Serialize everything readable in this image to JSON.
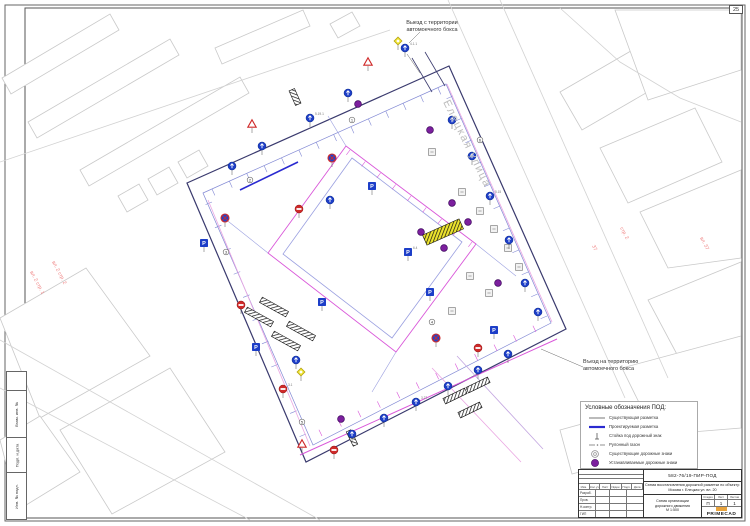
{
  "sheet": {
    "format_label": "25"
  },
  "stamps_left": [
    "Взам. инв. №",
    "Подп. и дата",
    "Инв. № подл."
  ],
  "annotations": {
    "exit_top": {
      "line1": "Выезд с территории",
      "line2": "автомоечного бокса"
    },
    "entry_right": {
      "line1": "Въезд на территорию",
      "line2": "автомоечного бокса"
    }
  },
  "legend": {
    "title": "Условные обозначения ПОД:",
    "items": [
      {
        "sym": "line-thin",
        "label": "Существующая разметка"
      },
      {
        "sym": "line-thick",
        "label": "Проектируемая разметка"
      },
      {
        "sym": "post",
        "label": "Стойка под дорожный знак"
      },
      {
        "sym": "dashdot",
        "label": "Рулонный газон"
      },
      {
        "sym": "circle-gray",
        "label": "Существующие дорожные знаки"
      },
      {
        "sym": "circle-purple",
        "label": "Устанавливаемые дорожные знаки"
      }
    ]
  },
  "title_block": {
    "code": "582-76/19-ПИР-ПОД",
    "object_lines": [
      "Схема восстановления дорожной разметки по объекту:",
      "Москва г. Елецкая ул. вл. 20"
    ],
    "columns": [
      "Изм.",
      "Кол.уч",
      "Лист",
      "№док.",
      "Подп.",
      "Дата"
    ],
    "roles": [
      "Разраб.",
      "Пров.",
      "Н.контр.",
      "ГИП"
    ],
    "stage_label": "Стадия",
    "sheet_label": "Лист",
    "sheets_label": "Листов",
    "stage": "П",
    "sheet": "1",
    "sheets": "1",
    "drawing_name_lines": [
      "Схема организации",
      "дорожного движения",
      "М 1:500"
    ],
    "logo": "PRIMECAD"
  },
  "map": {
    "colors": {
      "building": "#c9c9c9",
      "road": "#d2d2d2",
      "boundary": "#3a3a6e",
      "inner": "#8289d4",
      "courtyard": "#9ba0e0",
      "magenta": "#d957d9",
      "pink": "#eaa6e2",
      "lavender": "#c3a6e0",
      "blue": "#2a2ad0",
      "sign_blue": "#1d3ec8",
      "sign_red": "#cf2a2a",
      "purple": "#7c1f9e",
      "gray": "#8f8f8f",
      "yellow": "#ece32e",
      "leader": "#666666",
      "street_text": "#bdbdbd",
      "red_text": "#ef8080",
      "bar": "#1a1a1a"
    },
    "street_label": {
      "text": "Елецкая улица",
      "x": 443,
      "y": 102,
      "rot": 64,
      "size": 11
    },
    "red_labels": [
      {
        "text": "вл. 2 стр. 1",
        "x": 30,
        "y": 272,
        "rot": 62
      },
      {
        "text": "вл. 2 стр. 2",
        "x": 52,
        "y": 262,
        "rot": 62
      },
      {
        "text": "37",
        "x": 592,
        "y": 246,
        "rot": 62
      },
      {
        "text": "стр. 2",
        "x": 620,
        "y": 228,
        "rot": 62
      },
      {
        "text": "вл. 37",
        "x": 700,
        "y": 238,
        "rot": 62
      }
    ],
    "buildings": [
      [
        [
          2,
          78
        ],
        [
          110,
          14
        ],
        [
          119,
          30
        ],
        [
          11,
          94
        ]
      ],
      [
        [
          28,
          122
        ],
        [
          170,
          39
        ],
        [
          179,
          55
        ],
        [
          37,
          138
        ]
      ],
      [
        [
          80,
          170
        ],
        [
          240,
          77
        ],
        [
          249,
          93
        ],
        [
          89,
          186
        ]
      ],
      [
        [
          118,
          196
        ],
        [
          139,
          184
        ],
        [
          148,
          200
        ],
        [
          127,
          212
        ]
      ],
      [
        [
          148,
          179
        ],
        [
          169,
          167
        ],
        [
          178,
          183
        ],
        [
          157,
          195
        ]
      ],
      [
        [
          178,
          162
        ],
        [
          199,
          150
        ],
        [
          208,
          166
        ],
        [
          187,
          178
        ]
      ],
      [
        [
          215,
          48
        ],
        [
          303,
          10
        ],
        [
          310,
          26
        ],
        [
          222,
          64
        ]
      ],
      [
        [
          330,
          24
        ],
        [
          352,
          12
        ],
        [
          360,
          26
        ],
        [
          338,
          38
        ]
      ],
      [
        [
          560,
          92
        ],
        [
          636,
          48
        ],
        [
          658,
          86
        ],
        [
          582,
          130
        ]
      ],
      [
        [
          615,
          10
        ],
        [
          741,
          10
        ],
        [
          741,
          70
        ],
        [
          648,
          100
        ]
      ],
      [
        [
          600,
          148
        ],
        [
          695,
          108
        ],
        [
          722,
          162
        ],
        [
          628,
          203
        ]
      ],
      [
        [
          640,
          212
        ],
        [
          741,
          170
        ],
        [
          741,
          258
        ],
        [
          668,
          268
        ]
      ],
      [
        [
          648,
          300
        ],
        [
          741,
          262
        ],
        [
          741,
          350
        ],
        [
          680,
          360
        ]
      ],
      [
        [
          622,
          368
        ],
        [
          741,
          336
        ],
        [
          741,
          428
        ],
        [
          655,
          435
        ]
      ],
      [
        [
          560,
          430
        ],
        [
          640,
          408
        ],
        [
          652,
          452
        ],
        [
          572,
          474
        ]
      ],
      [
        [
          0,
          318
        ],
        [
          86,
          268
        ],
        [
          150,
          356
        ],
        [
          40,
          418
        ]
      ],
      [
        [
          60,
          430
        ],
        [
          170,
          368
        ],
        [
          225,
          452
        ],
        [
          112,
          514
        ]
      ],
      [
        [
          0,
          440
        ],
        [
          40,
          416
        ],
        [
          80,
          472
        ],
        [
          18,
          510
        ]
      ]
    ],
    "roads": [
      [
        [
          448,
          0
        ],
        [
          625,
          398
        ]
      ],
      [
        [
          500,
          0
        ],
        [
          668,
          378
        ]
      ],
      [
        [
          560,
          8
        ],
        [
          620,
          62
        ],
        [
          680,
          98
        ],
        [
          741,
          122
        ]
      ],
      [
        [
          0,
          340
        ],
        [
          320,
          520
        ]
      ],
      [
        [
          0,
          388
        ],
        [
          250,
          520
        ]
      ],
      [
        [
          0,
          162
        ],
        [
          390,
          30
        ]
      ]
    ],
    "lot": {
      "outer": [
        [
          187,
          183
        ],
        [
          449,
          66
        ],
        [
          566,
          329
        ],
        [
          306,
          462
        ]
      ],
      "inner": [
        [
          203,
          193
        ],
        [
          446,
          84
        ],
        [
          551,
          323
        ],
        [
          313,
          445
        ]
      ],
      "courtyard": [
        [
          352,
          158
        ],
        [
          462,
          242
        ],
        [
          392,
          338
        ],
        [
          283,
          254
        ]
      ],
      "magenta_ring": [
        [
          346,
          146
        ],
        [
          476,
          244
        ],
        [
          396,
          352
        ],
        [
          268,
          253
        ]
      ]
    },
    "tick_rows": [
      {
        "from": [
          212,
          189
        ],
        "to": [
          438,
          88
        ],
        "n": 14,
        "len": 7,
        "color": "inner"
      },
      {
        "from": [
          453,
          96
        ],
        "to": [
          547,
          316
        ],
        "n": 11,
        "len": 7,
        "color": "inner"
      },
      {
        "from": [
          536,
          332
        ],
        "to": [
          322,
          436
        ],
        "n": 12,
        "len": 7,
        "color": "magenta"
      },
      {
        "from": [
          212,
          202
        ],
        "to": [
          306,
          434
        ],
        "n": 11,
        "len": 7,
        "color": "inner"
      },
      {
        "from": [
          350,
          150
        ],
        "to": [
          472,
          242
        ],
        "n": 9,
        "len": 6,
        "color": "magenta"
      }
    ],
    "markings": [
      {
        "pts": [
          [
            208,
            200
          ],
          [
            310,
            446
          ]
        ],
        "c": "pink",
        "w": 0.8
      },
      {
        "pts": [
          [
            447,
            84
          ],
          [
            552,
            322
          ]
        ],
        "c": "pink",
        "w": 0.8
      },
      {
        "pts": [
          [
            432,
            368
          ],
          [
            521,
            462
          ]
        ],
        "c": "pink",
        "w": 0.8
      },
      {
        "pts": [
          [
            457,
            356
          ],
          [
            543,
            449
          ]
        ],
        "c": "lavender",
        "w": 0.8
      },
      {
        "pts": [
          [
            300,
            455
          ],
          [
            557,
            339
          ]
        ],
        "c": "magenta",
        "w": 1
      },
      {
        "pts": [
          [
            240,
            190
          ],
          [
            298,
            162
          ]
        ],
        "c": "blue",
        "w": 1.6
      },
      {
        "pts": [
          [
            412,
            58
          ],
          [
            432,
            92
          ]
        ],
        "c": "boundary",
        "w": 0.8
      },
      {
        "pts": [
          [
            425,
            52
          ],
          [
            445,
            86
          ]
        ],
        "c": "boundary",
        "w": 0.8
      },
      {
        "pts": [
          [
            268,
            253
          ],
          [
            224,
            218
          ]
        ],
        "c": "courtyard",
        "w": 0.6
      },
      {
        "pts": [
          [
            476,
            244
          ],
          [
            516,
            276
          ]
        ],
        "c": "courtyard",
        "w": 0.6
      },
      {
        "pts": [
          [
            396,
            352
          ],
          [
            372,
            392
          ]
        ],
        "c": "courtyard",
        "w": 0.6
      },
      {
        "pts": [
          [
            346,
            146
          ],
          [
            328,
            116
          ]
        ],
        "c": "courtyard",
        "w": 0.6
      }
    ],
    "bars": [
      {
        "x": 295,
        "y": 97,
        "rot": 66,
        "w": 16,
        "h": 6,
        "style": "black"
      },
      {
        "x": 274,
        "y": 307,
        "rot": 29,
        "w": 30,
        "h": 6,
        "style": "black"
      },
      {
        "x": 259,
        "y": 317,
        "rot": 29,
        "w": 30,
        "h": 6,
        "style": "black"
      },
      {
        "x": 301,
        "y": 331,
        "rot": 29,
        "w": 30,
        "h": 6,
        "style": "black"
      },
      {
        "x": 286,
        "y": 341,
        "rot": 29,
        "w": 30,
        "h": 6,
        "style": "black"
      },
      {
        "x": 443,
        "y": 232,
        "rot": -24,
        "w": 40,
        "h": 11,
        "style": "yellow"
      },
      {
        "x": 455,
        "y": 396,
        "rot": -26,
        "w": 24,
        "h": 6,
        "style": "black"
      },
      {
        "x": 478,
        "y": 385,
        "rot": -26,
        "w": 24,
        "h": 6,
        "style": "black"
      },
      {
        "x": 470,
        "y": 410,
        "rot": -26,
        "w": 24,
        "h": 6,
        "style": "black"
      },
      {
        "x": 352,
        "y": 438,
        "rot": 64,
        "w": 16,
        "h": 5,
        "style": "black"
      }
    ],
    "signs": [
      {
        "t": "yd",
        "x": 398,
        "y": 41
      },
      {
        "t": "bc",
        "x": 405,
        "y": 48,
        "lbl": "4.1.1"
      },
      {
        "t": "wt",
        "x": 368,
        "y": 62
      },
      {
        "t": "bc",
        "x": 348,
        "y": 93
      },
      {
        "t": "pd",
        "x": 358,
        "y": 104
      },
      {
        "t": "bc",
        "x": 310,
        "y": 118,
        "lbl": "5.19.1"
      },
      {
        "t": "wt",
        "x": 252,
        "y": 124
      },
      {
        "t": "bc",
        "x": 262,
        "y": 146
      },
      {
        "t": "nx",
        "x": 332,
        "y": 158
      },
      {
        "t": "bc",
        "x": 232,
        "y": 166
      },
      {
        "t": "cn",
        "x": 250,
        "y": 180,
        "n": "2"
      },
      {
        "t": "bp",
        "x": 372,
        "y": 186
      },
      {
        "t": "cn",
        "x": 352,
        "y": 120,
        "n": "1"
      },
      {
        "t": "gb",
        "x": 432,
        "y": 152
      },
      {
        "t": "pd",
        "x": 430,
        "y": 130
      },
      {
        "t": "cn",
        "x": 480,
        "y": 140,
        "n": "6"
      },
      {
        "t": "bc",
        "x": 452,
        "y": 120
      },
      {
        "t": "bc",
        "x": 472,
        "y": 156
      },
      {
        "t": "gb",
        "x": 462,
        "y": 192
      },
      {
        "t": "pd",
        "x": 452,
        "y": 203
      },
      {
        "t": "bc",
        "x": 490,
        "y": 196,
        "lbl": "5.15"
      },
      {
        "t": "gb",
        "x": 480,
        "y": 211
      },
      {
        "t": "pd",
        "x": 468,
        "y": 222
      },
      {
        "t": "gb",
        "x": 494,
        "y": 229
      },
      {
        "t": "pd",
        "x": 421,
        "y": 232
      },
      {
        "t": "bp",
        "x": 408,
        "y": 252,
        "lbl": "6.4"
      },
      {
        "t": "gb",
        "x": 508,
        "y": 248
      },
      {
        "t": "pd",
        "x": 444,
        "y": 248
      },
      {
        "t": "gb",
        "x": 519,
        "y": 267
      },
      {
        "t": "bc",
        "x": 509,
        "y": 240
      },
      {
        "t": "bc",
        "x": 525,
        "y": 283
      },
      {
        "t": "pd",
        "x": 498,
        "y": 283
      },
      {
        "t": "gb",
        "x": 489,
        "y": 293
      },
      {
        "t": "gb",
        "x": 470,
        "y": 276
      },
      {
        "t": "bp",
        "x": 430,
        "y": 292
      },
      {
        "t": "gb",
        "x": 452,
        "y": 311
      },
      {
        "t": "bc",
        "x": 538,
        "y": 312
      },
      {
        "t": "bp",
        "x": 494,
        "y": 330
      },
      {
        "t": "cn",
        "x": 432,
        "y": 322,
        "n": "4"
      },
      {
        "t": "nx",
        "x": 436,
        "y": 338
      },
      {
        "t": "ne",
        "x": 478,
        "y": 348
      },
      {
        "t": "bc",
        "x": 508,
        "y": 354
      },
      {
        "t": "bc",
        "x": 478,
        "y": 370
      },
      {
        "t": "bc",
        "x": 448,
        "y": 386
      },
      {
        "t": "bc",
        "x": 416,
        "y": 402,
        "lbl": "3.27"
      },
      {
        "t": "bc",
        "x": 384,
        "y": 418
      },
      {
        "t": "pd",
        "x": 341,
        "y": 419
      },
      {
        "t": "bc",
        "x": 352,
        "y": 434
      },
      {
        "t": "ne",
        "x": 334,
        "y": 450
      },
      {
        "t": "wt",
        "x": 302,
        "y": 444
      },
      {
        "t": "cn",
        "x": 302,
        "y": 422,
        "n": "5"
      },
      {
        "t": "yd",
        "x": 301,
        "y": 372
      },
      {
        "t": "ne",
        "x": 283,
        "y": 389,
        "lbl": "3.1"
      },
      {
        "t": "bp",
        "x": 256,
        "y": 347
      },
      {
        "t": "bc",
        "x": 296,
        "y": 360
      },
      {
        "t": "ne",
        "x": 241,
        "y": 305
      },
      {
        "t": "cn",
        "x": 226,
        "y": 252,
        "n": "3"
      },
      {
        "t": "bp",
        "x": 204,
        "y": 243
      },
      {
        "t": "nx",
        "x": 225,
        "y": 218
      },
      {
        "t": "ne",
        "x": 299,
        "y": 209
      },
      {
        "t": "bp",
        "x": 322,
        "y": 302
      },
      {
        "t": "bc",
        "x": 330,
        "y": 200
      }
    ],
    "leaders": [
      [
        [
          420,
          32
        ],
        [
          409,
          43
        ]
      ],
      [
        [
          583,
          367
        ],
        [
          541,
          349
        ]
      ],
      [
        [
          407,
          54
        ],
        [
          420,
          73
        ]
      ]
    ]
  }
}
